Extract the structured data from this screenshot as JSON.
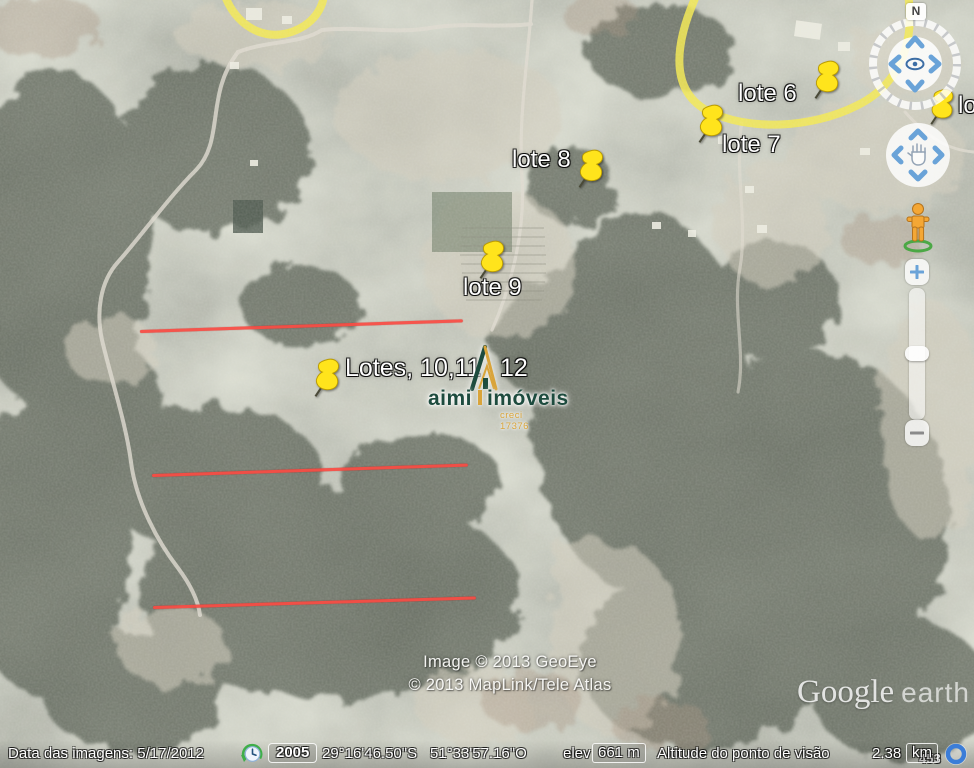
{
  "app": {
    "watermark_google": "Google",
    "watermark_earth": "earth"
  },
  "credits": {
    "line1": "Image © 2013 GeoEye",
    "line2": "© 2013 MapLink/Tele Atlas"
  },
  "placemarks": [
    {
      "id": "lote-6",
      "label": "lote 6"
    },
    {
      "id": "lote-7",
      "label": "lote 7"
    },
    {
      "id": "lote-8",
      "label": "lote 8"
    },
    {
      "id": "lote-9",
      "label": "lote 9"
    },
    {
      "id": "lotes-10-11-12",
      "label_before": "Lotes, 10,11",
      "label_after": "12"
    },
    {
      "id": "lote-clipped",
      "label": "lo"
    }
  ],
  "brand": {
    "name_primary": "aimi",
    "name_secondary": "imóveis",
    "registration": "creci 17376",
    "color_green": "#1d4b3e",
    "color_gold": "#d9a43a"
  },
  "map_labels": {
    "road_shield": "453"
  },
  "navigation": {
    "north_label": "N"
  },
  "annotations": {
    "property_line_color": "#fa4b43",
    "property_line_count": 3
  },
  "status_bar": {
    "imagery_date_label": "Data das imagens:",
    "imagery_date_value": "5/17/2012",
    "timeline_year": "2005",
    "latitude": "29°16'46.50\"S",
    "longitude": "51°33'57.16\"O",
    "elevation_label": "elev",
    "elevation_value": "661 m",
    "view_altitude_label": "Altitude do ponto de visão",
    "view_altitude_value": "2.38",
    "view_altitude_unit": "km"
  }
}
